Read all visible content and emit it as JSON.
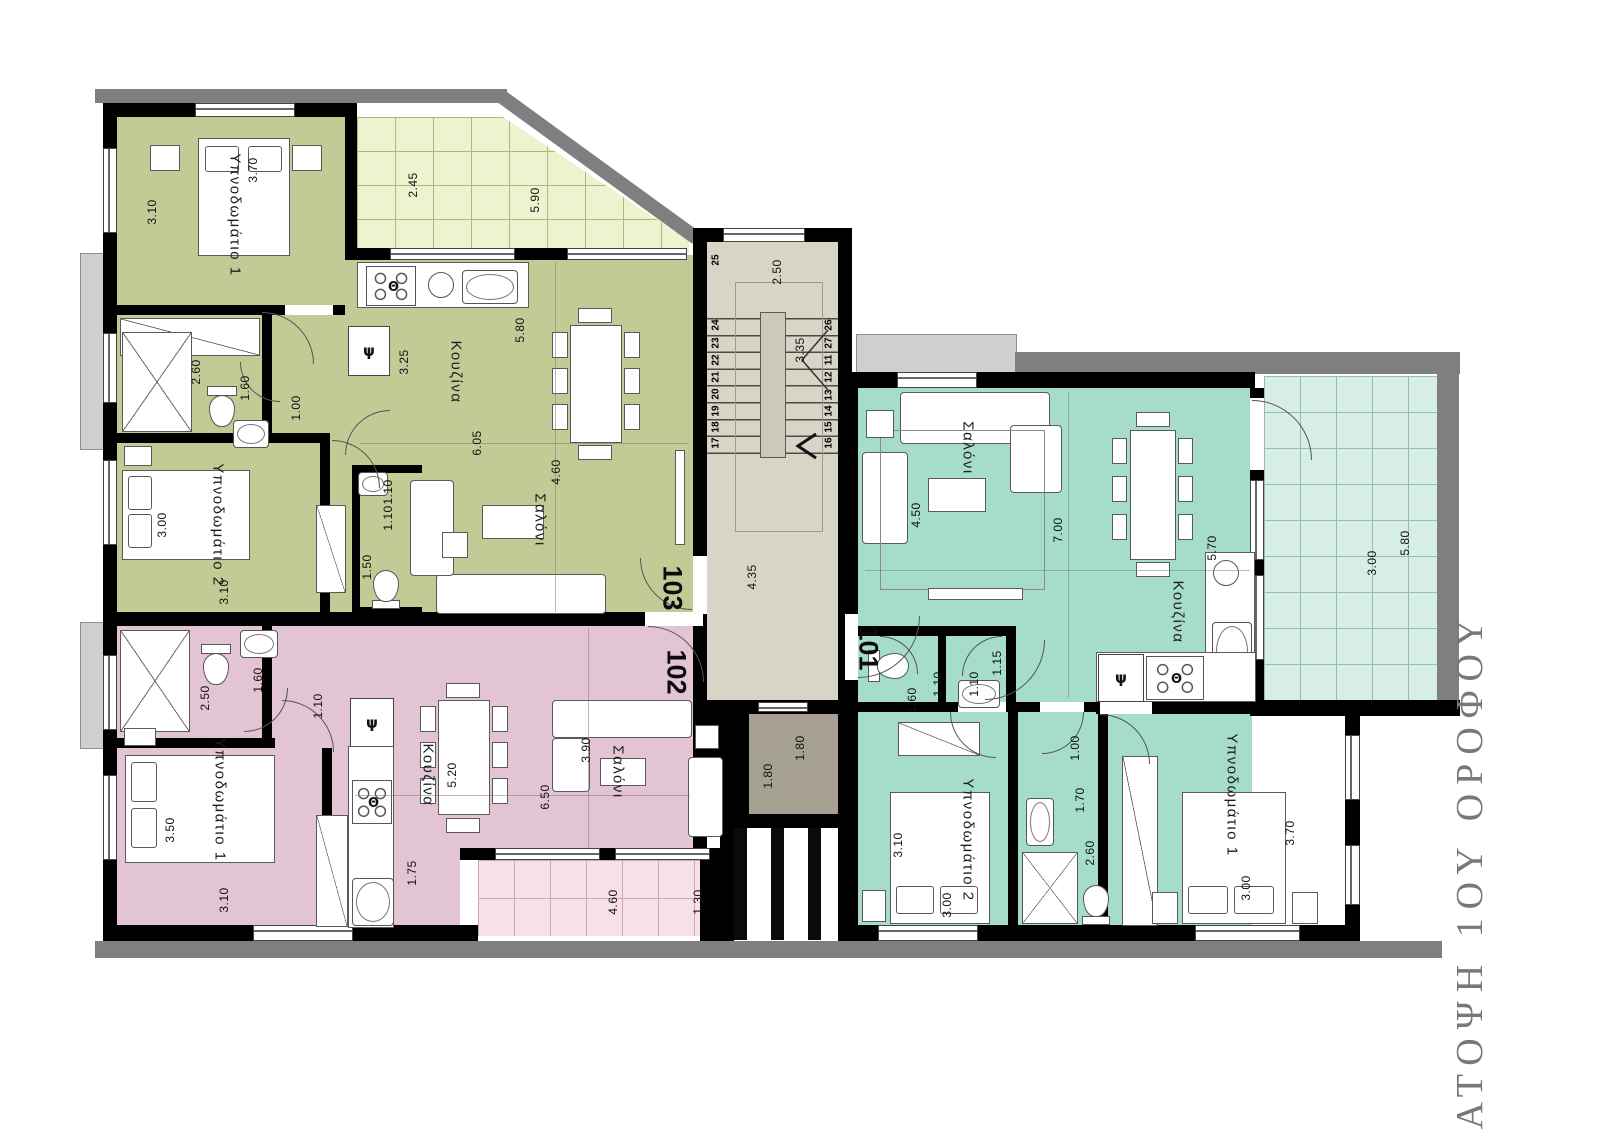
{
  "title": "ΚΑΤΟΨΗ 1ΟΥ ΟΡΟΦΟΥ",
  "symbols": {
    "fridge": "ψ",
    "stove": "Θ"
  },
  "apartments": {
    "a103": {
      "number": "103",
      "bedroom1": {
        "label": "Υπνοδωμάτιο 1",
        "w": "3.70",
        "h": "3.10"
      },
      "bedroom2": {
        "label": "Υπνοδωμάτιο 2",
        "w": "3.00",
        "h": "3.10"
      },
      "bath": {
        "d1": "2.60",
        "d2": "1.60",
        "d3": "1.00"
      },
      "wc": {
        "d1": "1.10",
        "d2": "1.10",
        "d3": "1.50"
      },
      "kitchen": {
        "label": "Κουζίνα",
        "d1": "5.80",
        "d2": "3.25",
        "d3": "6.05"
      },
      "salon": {
        "label": "Σαλόνι",
        "d1": "4.60"
      },
      "balcony": {
        "d1": "2.45",
        "d2": "5.90"
      }
    },
    "a102": {
      "number": "102",
      "bedroom1": {
        "label": "Υπνοδωμάτιο 1",
        "w": "3.50",
        "h": "3.10"
      },
      "bath": {
        "d1": "2.50",
        "d2": "1.60",
        "d3": "1.10"
      },
      "kitchen": {
        "label": "Κουζίνα",
        "d1": "5.20",
        "d2": "1.75"
      },
      "salon": {
        "label": "Σαλόνι",
        "d1": "3.90",
        "d2": "6.50"
      },
      "balcony": {
        "d1": "4.60",
        "d2": "1.30"
      }
    },
    "a101": {
      "number": "101",
      "salon": {
        "label": "Σαλόνι",
        "d1": "4.50",
        "d2": "7.00"
      },
      "kitchen": {
        "label": "Κουζίνα",
        "d1": "5.70"
      },
      "hall": {
        "d1": "1.00"
      },
      "wc": {
        "d1": "1.10",
        "d2": "1.10",
        "d3": "1.15",
        "d4": "1.60"
      },
      "bath": {
        "d1": "2.60",
        "d2": "1.70"
      },
      "bedroom1": {
        "label": "Υπνοδωμάτιο 1",
        "w": "3.70",
        "h": "3.00"
      },
      "bedroom2": {
        "label": "Υπνοδωμάτιο 2",
        "w": "3.10",
        "h": "3.00"
      },
      "balcony": {
        "d1": "3.00",
        "d2": "5.80"
      }
    }
  },
  "core": {
    "stairs": {
      "width": "2.50",
      "run": "3.35",
      "hall": "4.35",
      "steps_left": [
        "25",
        "24",
        "23",
        "22",
        "21",
        "20",
        "19",
        "18",
        "17"
      ],
      "steps_right": [
        "26",
        "27",
        "11",
        "12",
        "13",
        "14",
        "15",
        "16"
      ]
    },
    "elevator": {
      "w": "1.80",
      "h": "1.80"
    }
  }
}
